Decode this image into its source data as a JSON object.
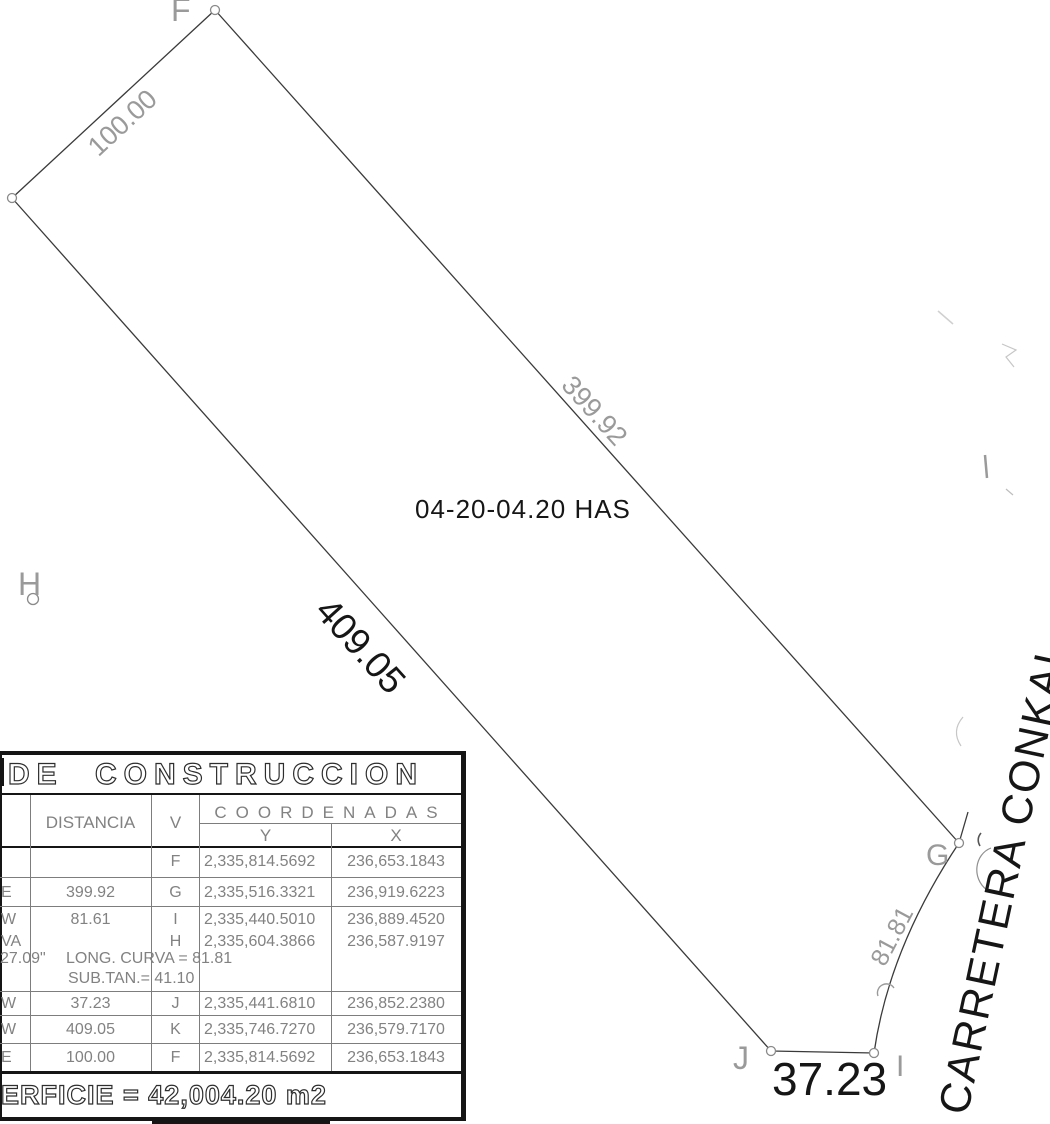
{
  "plan": {
    "area": "04-20-04.20 HAS",
    "road": "CARRETERA CONKAL",
    "dim_kf": "100.00",
    "dim_fg": "399.92",
    "dim_jk": "409.05",
    "dim_ij": "37.23",
    "dim_curve": "81.81",
    "v_f": "F",
    "v_g": "G",
    "v_h": "H",
    "v_i": "I",
    "v_j": "J"
  },
  "table": {
    "title": "DE CONSTRUCCION",
    "col_distancia": "DISTANCIA",
    "col_v": "V",
    "col_coordenadas": "COORDENADAS",
    "col_y": "Y",
    "col_x": "X",
    "rows": [
      {
        "rumbo": "",
        "dist": "",
        "v": "F",
        "y": "2,335,814.5692",
        "x": "236,653.1843"
      },
      {
        "rumbo": "E",
        "dist": "399.92",
        "v": "G",
        "y": "2,335,516.3321",
        "x": "236,919.6223"
      },
      {
        "rumbo": "W",
        "dist": "81.61",
        "v": "I",
        "y": "2,335,440.5010",
        "x": "236,889.4520"
      },
      {
        "rumbo": "VA",
        "dist": "",
        "v": "H",
        "y": "2,335,604.3866",
        "x": "236,587.9197"
      },
      {
        "rumbo": "W",
        "dist": "37.23",
        "v": "J",
        "y": "2,335,441.6810",
        "x": "236,852.2380"
      },
      {
        "rumbo": "W",
        "dist": "409.05",
        "v": "K",
        "y": "2,335,746.7270",
        "x": "236,579.7170"
      },
      {
        "rumbo": "E",
        "dist": "100.00",
        "v": "F",
        "y": "2,335,814.5692",
        "x": "236,653.1843"
      }
    ],
    "angle_fragment": "27.09\"",
    "curve_note_long": "LONG. CURVA = 81.81",
    "curve_note_subtan": "SUB.TAN.= 41.10",
    "superficie": "ERFICIE = 42,004.20 m2"
  },
  "colors": {
    "ink": "#3a3a3a",
    "muted_text": "#828282",
    "label_gray": "#9a9a9a"
  }
}
